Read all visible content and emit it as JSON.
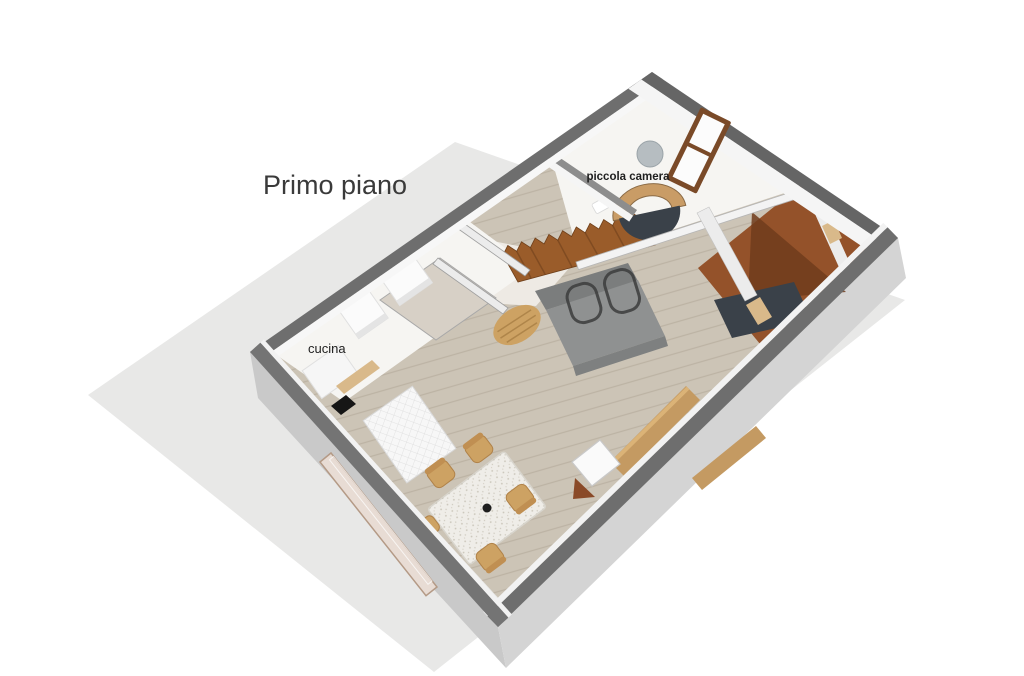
{
  "labels": {
    "floor_title": "Primo piano",
    "room_bedroom": "piccola camera",
    "room_kitchen": "cucina"
  },
  "rooms": [
    {
      "name": "piccola camera"
    },
    {
      "name": "cucina"
    }
  ],
  "colors": {
    "page_bg": "#ffffff",
    "shadow": "#e8e8e7",
    "wall_top": "#6e6e6e",
    "wall_top_dark": "#656565",
    "wall_top_sw": "#747474",
    "wall_face_sw": "#c9c9c9",
    "wall_face_se": "#d4d4d4",
    "wall_inner": "#f5f5f5",
    "floor_wood": "#ccc4b6",
    "plank": "#b4aa99",
    "floor_white": "#f6f5f2",
    "floor_hall": "#eeeae4",
    "floor_beige": "#d7d0c6",
    "room_brown": "#94522a",
    "room_brown_dark": "#703c1c",
    "stairs": "#9a5c2a",
    "stairs_edge": "#6e3f1a",
    "sofa": "#8f9191",
    "sofa_back": "#7b7d7d",
    "sofa_front": "#7e8080",
    "dark_wire": "#3c3c3c",
    "bed_navy": "#3a4149",
    "headboard": "#c99c66",
    "window_brown": "#7a4a28",
    "pane": "#fcfcfc",
    "table": "#efede8",
    "speckle": "#c6c1b4",
    "chair": "#cda263",
    "chair_edge": "#b08249",
    "wood_furn": "#c49a62",
    "wood_furn_top": "#dbb377",
    "threshold": "#d9b98a",
    "lamp": "#b6bdc1",
    "sink": "#161616",
    "glass_sw": "#e8dcd4",
    "glass_sw_edge": "#b49a86",
    "tile_line": "#dcdcdc",
    "cube": "#fafafa",
    "cube_edge": "#c9c9c9",
    "wall_int": "#ececec",
    "wall_int_edge": "#9f9f9f",
    "text": "#3a3a3a",
    "label": "#1f1f1f"
  }
}
